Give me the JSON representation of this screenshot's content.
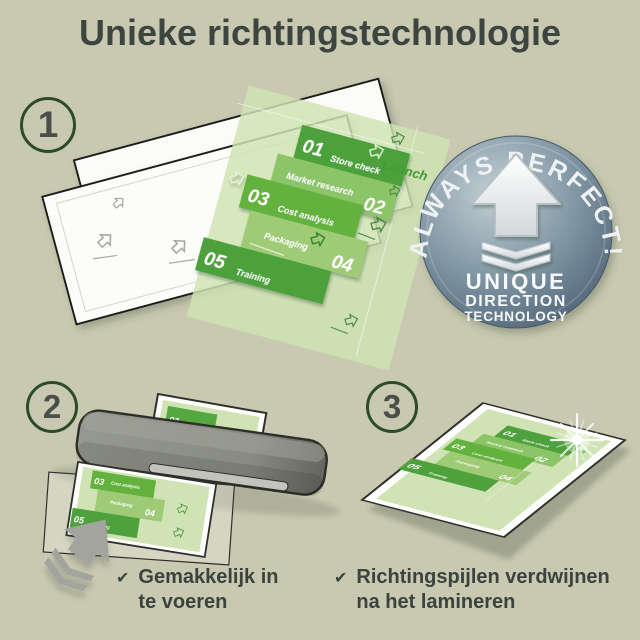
{
  "title": "Unieke richtingstechnologie",
  "steps": {
    "one": {
      "number": "1"
    },
    "two": {
      "number": "2"
    },
    "three": {
      "number": "3"
    }
  },
  "flyer": {
    "launch": "Launch",
    "items": [
      {
        "num": "01",
        "label": "Store check"
      },
      {
        "num": "02",
        "label": "Market research"
      },
      {
        "num": "03",
        "label": "Cost analysis"
      },
      {
        "num": "04",
        "label": "Packaging"
      },
      {
        "num": "05",
        "label": "Training"
      }
    ]
  },
  "badge": {
    "arc_text": "ALWAYS PERFECT!",
    "line1": "UNIQUE",
    "line2": "DIRECTION",
    "line3": "TECHNOLOGY"
  },
  "captions": {
    "feed": {
      "check": "✔",
      "text": "Gemakkelijk in\nte voeren"
    },
    "arrows": {
      "check": "✔",
      "text": "Richtingspijlen verdwijnen\nna het lamineren"
    }
  },
  "colors": {
    "background": "#c8c9b0",
    "accent_green": "#4ea13d",
    "flyer_light_green": "#cfe3b4",
    "badge_steel": "#7d93a2",
    "text_dark": "#3c443f",
    "machine_gray": "#8b8e86"
  }
}
